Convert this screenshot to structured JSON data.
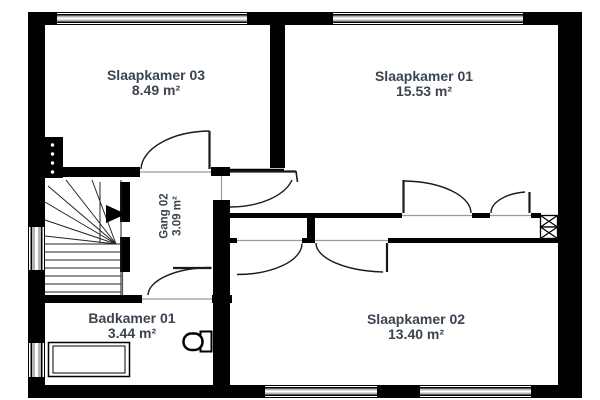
{
  "rooms": [
    {
      "id": "slaapkamer-03",
      "name": "Slaapkamer 03",
      "area": "8.49 m²"
    },
    {
      "id": "slaapkamer-01",
      "name": "Slaapkamer 01",
      "area": "15.53 m²"
    },
    {
      "id": "slaapkamer-02",
      "name": "Slaapkamer 02",
      "area": "13.40 m²"
    },
    {
      "id": "badkamer-01",
      "name": "Badkamer 01",
      "area": "3.44 m²"
    },
    {
      "id": "gang-02",
      "name": "Gang 02",
      "area": "3.09 m²"
    }
  ],
  "fixtures": [
    "staircase-icon",
    "stair-direction-arrow-icon",
    "toilet-icon",
    "bathtub-icon",
    "duct-shaft-icon",
    "meter-cupboard-icon",
    "window",
    "door-swing"
  ],
  "colors": {
    "wall": "#000000",
    "text": "#3b4450",
    "window_gray": "#b5b5b5",
    "line": "#1a1a1a"
  }
}
